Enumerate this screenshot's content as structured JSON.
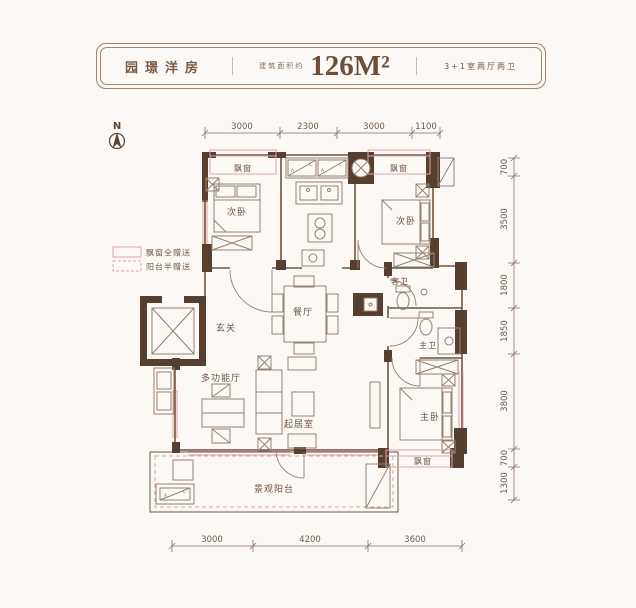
{
  "header": {
    "title": "园璟洋房",
    "area_prefix": "建筑面积约",
    "area_value": "126M²",
    "layout": "3+1室两厅两卫"
  },
  "north": {
    "label": "N"
  },
  "legend": {
    "bay": "飘窗全赠送",
    "balcony": "阳台半赠送"
  },
  "rooms": {
    "bay_left": "飘窗",
    "bay_right": "飘窗",
    "bay_master": "飘窗",
    "bedroom_left": "次卧",
    "bedroom_right": "次卧",
    "master": "主卧",
    "dining": "餐厅",
    "foyer": "玄关",
    "multi": "多功能厅",
    "living": "起居室",
    "guest_bath": "客卫",
    "master_bath": "主卫",
    "balcony": "景观阳台"
  },
  "ac": {
    "a": "A",
    "c": "C"
  },
  "dims": {
    "top": [
      "3000",
      "2300",
      "3000",
      "1100"
    ],
    "right": [
      "700",
      "3500",
      "1800",
      "1850",
      "3800",
      "700",
      "1300"
    ],
    "bottom": [
      "3000",
      "4200",
      "3600"
    ]
  },
  "colors": {
    "wall_dark": "#573f30",
    "wall_line": "#6e5340",
    "furniture_line": "#97806e",
    "window_pink": "#dfa3a8",
    "text_brown": "#6e5140"
  }
}
